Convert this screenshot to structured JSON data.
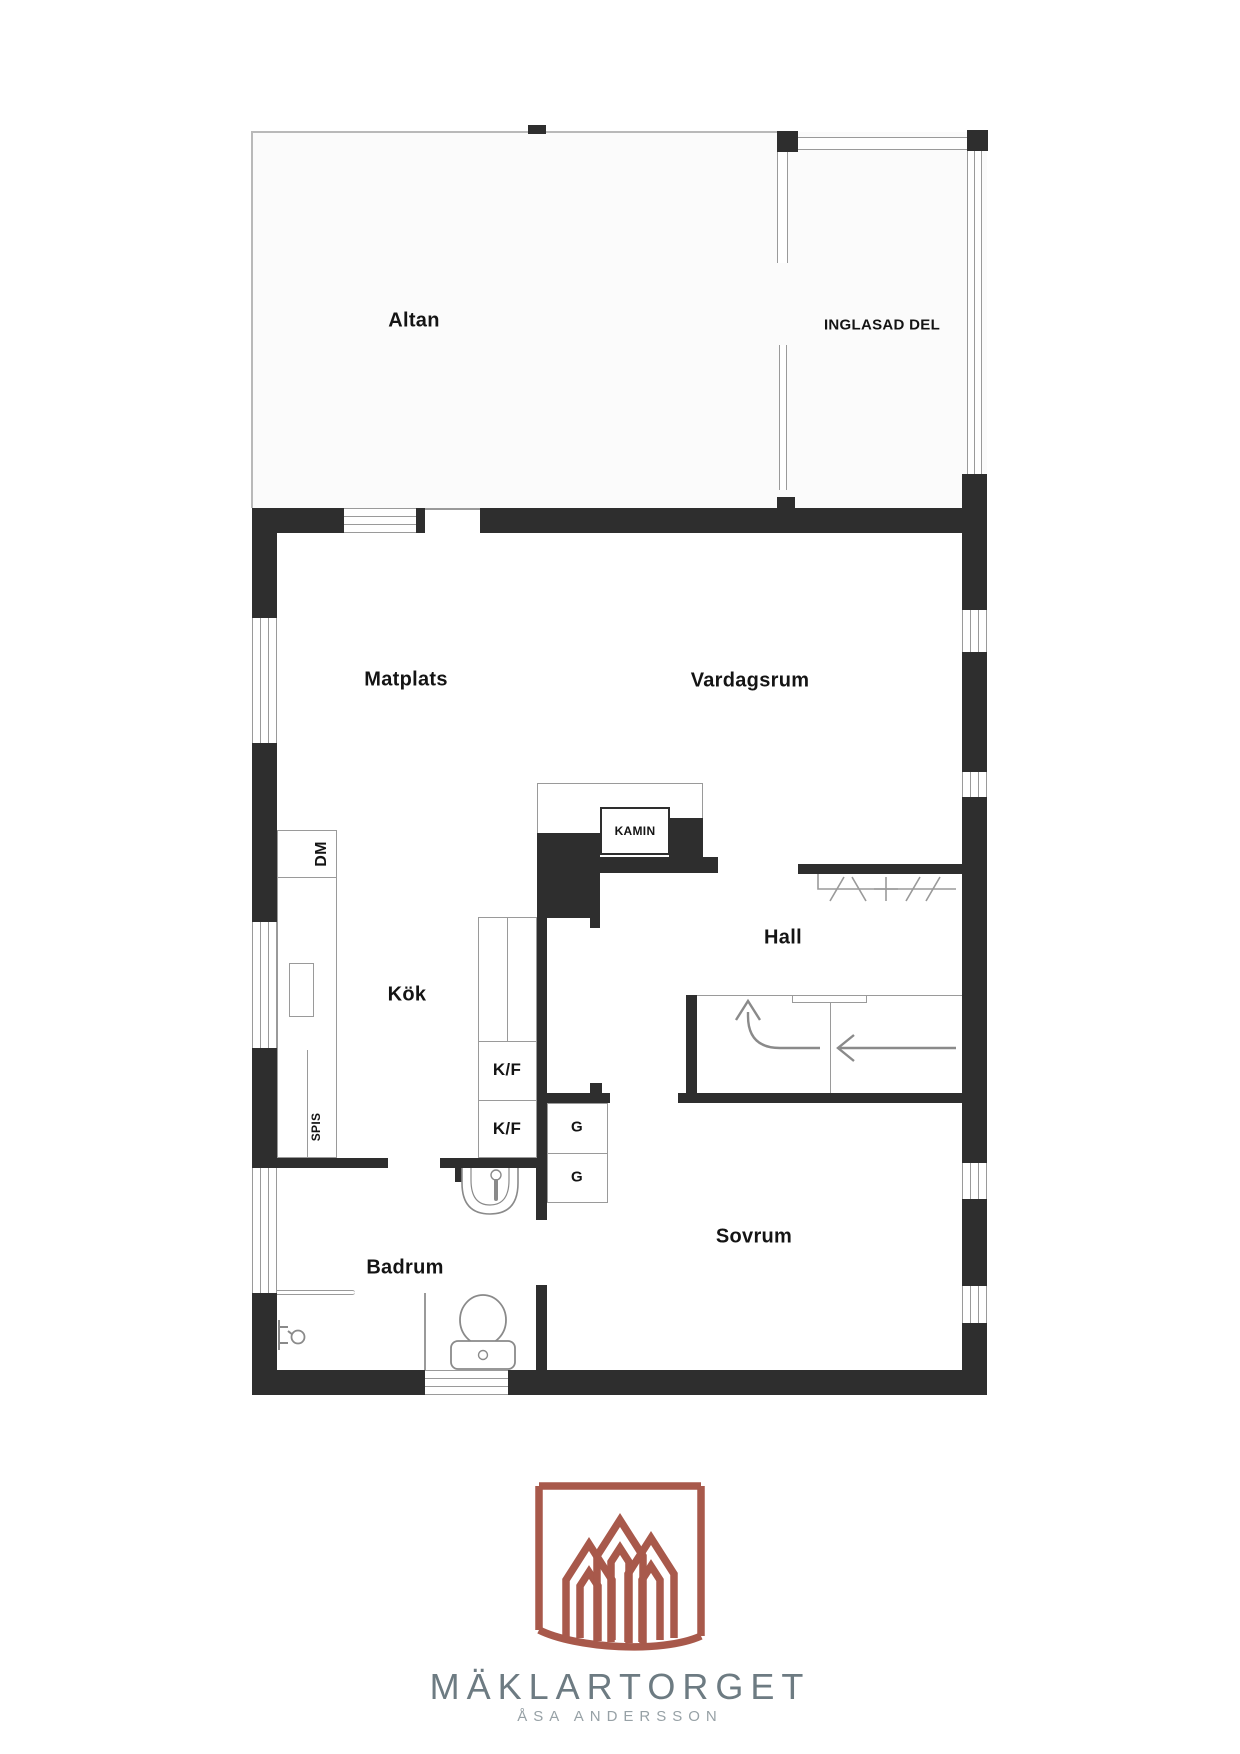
{
  "floorplan": {
    "rooms": {
      "altan": "Altan",
      "inglasad": "INGLASAD DEL",
      "matplats": "Matplats",
      "vardagsrum": "Vardagsrum",
      "kok": "Kök",
      "hall": "Hall",
      "sovrum": "Sovrum",
      "badrum": "Badrum"
    },
    "appliances": {
      "kamin": "KAMIN",
      "dm": "DM",
      "spis": "SPIS",
      "kf_upper": "K/F",
      "kf_lower": "K/F",
      "g_upper": "G",
      "g_lower": "G"
    }
  },
  "logo": {
    "brand": "MÄKLARTORGET",
    "agent": "ÅSA ANDERSSON"
  },
  "colors": {
    "wall": "#2e2e2e",
    "outline": "#9a9a9a",
    "deck_edge": "#b9b9b9",
    "logo_emblem": "#a8594b",
    "logo_brand_text": "#6d7b82",
    "logo_agent_text": "#97a1a6"
  }
}
